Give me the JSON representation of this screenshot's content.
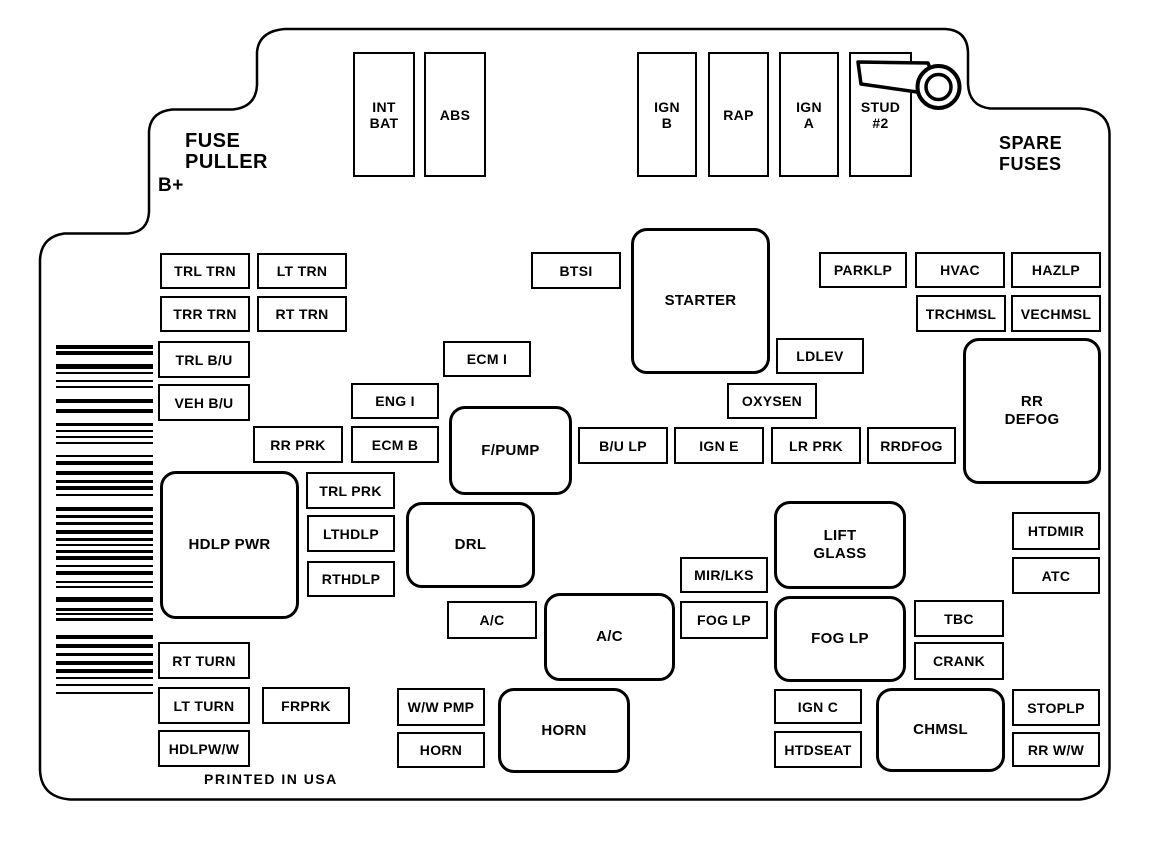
{
  "colors": {
    "line": "#000000",
    "background": "#ffffff"
  },
  "labels": {
    "fuse_puller_line1": "FUSE",
    "fuse_puller_line2": "PULLER",
    "b_plus": "B+",
    "spare_fuses_line1": "SPARE",
    "spare_fuses_line2": "FUSES",
    "printed_in_usa": "PRINTED IN USA"
  },
  "fuses": [
    {
      "id": "int-bat",
      "label": "INT\nBAT",
      "x": 353,
      "y": 52,
      "w": 62,
      "h": 125,
      "shape": "rect"
    },
    {
      "id": "abs",
      "label": "ABS",
      "x": 424,
      "y": 52,
      "w": 62,
      "h": 125,
      "shape": "rect"
    },
    {
      "id": "ign-b",
      "label": "IGN\nB",
      "x": 637,
      "y": 52,
      "w": 60,
      "h": 125,
      "shape": "rect"
    },
    {
      "id": "rap",
      "label": "RAP",
      "x": 708,
      "y": 52,
      "w": 61,
      "h": 125,
      "shape": "rect"
    },
    {
      "id": "ign-a",
      "label": "IGN\nA",
      "x": 779,
      "y": 52,
      "w": 60,
      "h": 125,
      "shape": "rect"
    },
    {
      "id": "stud-2",
      "label": "STUD\n#2",
      "x": 849,
      "y": 52,
      "w": 63,
      "h": 125,
      "shape": "rect"
    },
    {
      "id": "trl-trn",
      "label": "TRL TRN",
      "x": 160,
      "y": 253,
      "w": 90,
      "h": 36,
      "shape": "rect"
    },
    {
      "id": "lt-trn",
      "label": "LT TRN",
      "x": 257,
      "y": 253,
      "w": 90,
      "h": 36,
      "shape": "rect"
    },
    {
      "id": "trr-trn",
      "label": "TRR TRN",
      "x": 160,
      "y": 296,
      "w": 90,
      "h": 36,
      "shape": "rect"
    },
    {
      "id": "rt-trn",
      "label": "RT TRN",
      "x": 257,
      "y": 296,
      "w": 90,
      "h": 36,
      "shape": "rect"
    },
    {
      "id": "btsi",
      "label": "BTSI",
      "x": 531,
      "y": 252,
      "w": 90,
      "h": 37,
      "shape": "rect"
    },
    {
      "id": "parklp",
      "label": "PARKLP",
      "x": 819,
      "y": 252,
      "w": 88,
      "h": 36,
      "shape": "rect"
    },
    {
      "id": "hvac",
      "label": "HVAC",
      "x": 915,
      "y": 252,
      "w": 90,
      "h": 36,
      "shape": "rect"
    },
    {
      "id": "hazlp",
      "label": "HAZLP",
      "x": 1011,
      "y": 252,
      "w": 90,
      "h": 36,
      "shape": "rect"
    },
    {
      "id": "trchmsl",
      "label": "TRCHMSL",
      "x": 916,
      "y": 295,
      "w": 90,
      "h": 37,
      "shape": "rect"
    },
    {
      "id": "vechmsl",
      "label": "VECHMSL",
      "x": 1011,
      "y": 295,
      "w": 90,
      "h": 37,
      "shape": "rect"
    },
    {
      "id": "starter",
      "label": "STARTER",
      "x": 631,
      "y": 228,
      "w": 139,
      "h": 146,
      "shape": "rounded"
    },
    {
      "id": "trl-bu",
      "label": "TRL B/U",
      "x": 158,
      "y": 341,
      "w": 92,
      "h": 37,
      "shape": "rect"
    },
    {
      "id": "ecm-i",
      "label": "ECM I",
      "x": 443,
      "y": 341,
      "w": 88,
      "h": 36,
      "shape": "rect"
    },
    {
      "id": "ldlev",
      "label": "LDLEV",
      "x": 776,
      "y": 338,
      "w": 88,
      "h": 36,
      "shape": "rect"
    },
    {
      "id": "veh-bu",
      "label": "VEH B/U",
      "x": 158,
      "y": 384,
      "w": 92,
      "h": 37,
      "shape": "rect"
    },
    {
      "id": "eng-i",
      "label": "ENG I",
      "x": 351,
      "y": 383,
      "w": 88,
      "h": 36,
      "shape": "rect"
    },
    {
      "id": "oxysen",
      "label": "OXYSEN",
      "x": 727,
      "y": 383,
      "w": 90,
      "h": 36,
      "shape": "rect"
    },
    {
      "id": "rr-defog",
      "label": "RR\nDEFOG",
      "x": 963,
      "y": 338,
      "w": 138,
      "h": 146,
      "shape": "rounded"
    },
    {
      "id": "rr-prk",
      "label": "RR PRK",
      "x": 253,
      "y": 426,
      "w": 90,
      "h": 37,
      "shape": "rect"
    },
    {
      "id": "ecm-b",
      "label": "ECM B",
      "x": 351,
      "y": 426,
      "w": 88,
      "h": 37,
      "shape": "rect"
    },
    {
      "id": "f-pump",
      "label": "F/PUMP",
      "x": 449,
      "y": 406,
      "w": 123,
      "h": 89,
      "shape": "rounded"
    },
    {
      "id": "bu-lp",
      "label": "B/U LP",
      "x": 578,
      "y": 427,
      "w": 90,
      "h": 37,
      "shape": "rect"
    },
    {
      "id": "ign-e",
      "label": "IGN E",
      "x": 674,
      "y": 427,
      "w": 90,
      "h": 37,
      "shape": "rect"
    },
    {
      "id": "lr-prk",
      "label": "LR PRK",
      "x": 771,
      "y": 427,
      "w": 90,
      "h": 37,
      "shape": "rect"
    },
    {
      "id": "rrdfog",
      "label": "RRDFOG",
      "x": 867,
      "y": 427,
      "w": 89,
      "h": 37,
      "shape": "rect"
    },
    {
      "id": "hdlp-pwr",
      "label": "HDLP PWR",
      "x": 160,
      "y": 471,
      "w": 139,
      "h": 148,
      "shape": "rounded"
    },
    {
      "id": "trl-prk",
      "label": "TRL PRK",
      "x": 306,
      "y": 472,
      "w": 89,
      "h": 37,
      "shape": "rect"
    },
    {
      "id": "lthdlp",
      "label": "LTHDLP",
      "x": 307,
      "y": 515,
      "w": 88,
      "h": 37,
      "shape": "rect"
    },
    {
      "id": "rthdlp",
      "label": "RTHDLP",
      "x": 307,
      "y": 561,
      "w": 88,
      "h": 36,
      "shape": "rect"
    },
    {
      "id": "drl",
      "label": "DRL",
      "x": 406,
      "y": 502,
      "w": 129,
      "h": 86,
      "shape": "rounded"
    },
    {
      "id": "lift-glass",
      "label": "LIFT\nGLASS",
      "x": 774,
      "y": 501,
      "w": 132,
      "h": 88,
      "shape": "rounded"
    },
    {
      "id": "htdmir",
      "label": "HTDMIR",
      "x": 1012,
      "y": 512,
      "w": 88,
      "h": 38,
      "shape": "rect"
    },
    {
      "id": "atc",
      "label": "ATC",
      "x": 1012,
      "y": 557,
      "w": 88,
      "h": 37,
      "shape": "rect"
    },
    {
      "id": "mir-lks",
      "label": "MIR/LKS",
      "x": 680,
      "y": 557,
      "w": 88,
      "h": 36,
      "shape": "rect"
    },
    {
      "id": "ac-small",
      "label": "A/C",
      "x": 447,
      "y": 601,
      "w": 90,
      "h": 38,
      "shape": "rect"
    },
    {
      "id": "ac-big",
      "label": "A/C",
      "x": 544,
      "y": 593,
      "w": 131,
      "h": 88,
      "shape": "rounded"
    },
    {
      "id": "fog-lp-small",
      "label": "FOG LP",
      "x": 680,
      "y": 601,
      "w": 88,
      "h": 38,
      "shape": "rect"
    },
    {
      "id": "fog-lp-big",
      "label": "FOG LP",
      "x": 774,
      "y": 596,
      "w": 132,
      "h": 86,
      "shape": "rounded"
    },
    {
      "id": "tbc",
      "label": "TBC",
      "x": 914,
      "y": 600,
      "w": 90,
      "h": 37,
      "shape": "rect"
    },
    {
      "id": "crank",
      "label": "CRANK",
      "x": 914,
      "y": 642,
      "w": 90,
      "h": 38,
      "shape": "rect"
    },
    {
      "id": "rt-turn",
      "label": "RT TURN",
      "x": 158,
      "y": 642,
      "w": 92,
      "h": 37,
      "shape": "rect"
    },
    {
      "id": "lt-turn",
      "label": "LT TURN",
      "x": 158,
      "y": 687,
      "w": 92,
      "h": 37,
      "shape": "rect"
    },
    {
      "id": "frprk",
      "label": "FRPRK",
      "x": 262,
      "y": 687,
      "w": 88,
      "h": 37,
      "shape": "rect"
    },
    {
      "id": "hdlpww",
      "label": "HDLPW/W",
      "x": 158,
      "y": 730,
      "w": 92,
      "h": 37,
      "shape": "rect"
    },
    {
      "id": "ww-pmp",
      "label": "W/W PMP",
      "x": 397,
      "y": 688,
      "w": 88,
      "h": 38,
      "shape": "rect"
    },
    {
      "id": "horn-small",
      "label": "HORN",
      "x": 397,
      "y": 732,
      "w": 88,
      "h": 36,
      "shape": "rect"
    },
    {
      "id": "horn-big",
      "label": "HORN",
      "x": 498,
      "y": 688,
      "w": 132,
      "h": 85,
      "shape": "rounded"
    },
    {
      "id": "ign-c",
      "label": "IGN C",
      "x": 774,
      "y": 689,
      "w": 88,
      "h": 35,
      "shape": "rect"
    },
    {
      "id": "htdseat",
      "label": "HTDSEAT",
      "x": 774,
      "y": 731,
      "w": 88,
      "h": 37,
      "shape": "rect"
    },
    {
      "id": "chmsl",
      "label": "CHMSL",
      "x": 876,
      "y": 688,
      "w": 129,
      "h": 84,
      "shape": "rounded"
    },
    {
      "id": "stoplp",
      "label": "STOPLP",
      "x": 1012,
      "y": 689,
      "w": 88,
      "h": 37,
      "shape": "rect"
    },
    {
      "id": "rr-ww",
      "label": "RR W/W",
      "x": 1012,
      "y": 732,
      "w": 88,
      "h": 35,
      "shape": "rect"
    }
  ],
  "barcode": {
    "x": 56,
    "w": 97,
    "bars": [
      [
        345,
        4
      ],
      [
        351,
        4
      ],
      [
        364,
        5
      ],
      [
        372,
        2
      ],
      [
        380,
        2
      ],
      [
        386,
        2
      ],
      [
        399,
        4
      ],
      [
        409,
        4
      ],
      [
        423,
        3
      ],
      [
        430,
        2
      ],
      [
        436,
        2
      ],
      [
        442,
        2
      ],
      [
        455,
        2
      ],
      [
        461,
        4
      ],
      [
        471,
        4
      ],
      [
        480,
        3
      ],
      [
        486,
        4
      ],
      [
        494,
        2
      ],
      [
        507,
        4
      ],
      [
        515,
        3
      ],
      [
        522,
        3
      ],
      [
        530,
        4
      ],
      [
        538,
        3
      ],
      [
        544,
        2
      ],
      [
        550,
        3
      ],
      [
        556,
        4
      ],
      [
        565,
        2
      ],
      [
        571,
        4
      ],
      [
        581,
        2
      ],
      [
        586,
        2
      ],
      [
        597,
        5
      ],
      [
        608,
        3
      ],
      [
        613,
        2
      ],
      [
        618,
        3
      ],
      [
        635,
        4
      ],
      [
        644,
        4
      ],
      [
        653,
        3
      ],
      [
        661,
        4
      ],
      [
        669,
        4
      ],
      [
        677,
        2
      ],
      [
        684,
        2
      ],
      [
        692,
        2
      ]
    ]
  }
}
